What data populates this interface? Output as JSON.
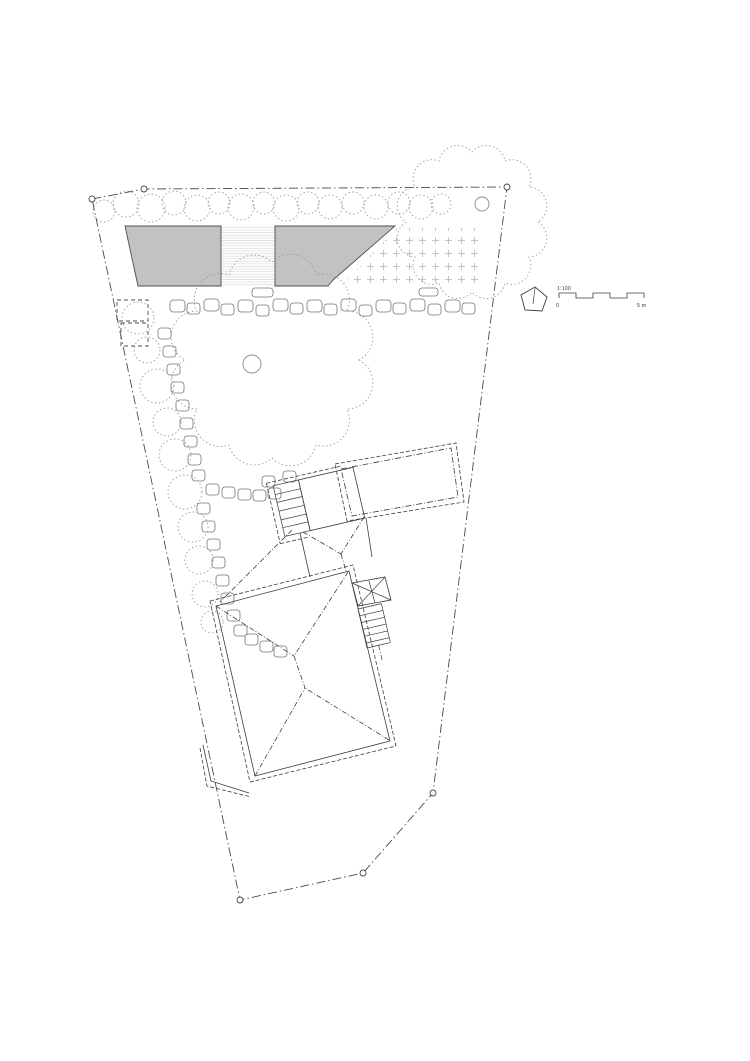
{
  "drawing": {
    "name": "architectural-site-plan",
    "type": "roof / site plan"
  },
  "legend": {
    "scale_ratio": "1:100",
    "scale_zero": "0",
    "scale_max": "5 m",
    "north_icon": "north-arrow-icon"
  },
  "colors": {
    "background": "#ffffff",
    "ink": "#3c3c3c",
    "boundary": "#4a4a4a",
    "building_fill": "#c2c2c2",
    "vegetation_dotted": "#9a9a9a",
    "shrub_outline": "#757575",
    "hatch_lines": "#d6d6d6",
    "plus_marks": "#b5b5b5"
  }
}
